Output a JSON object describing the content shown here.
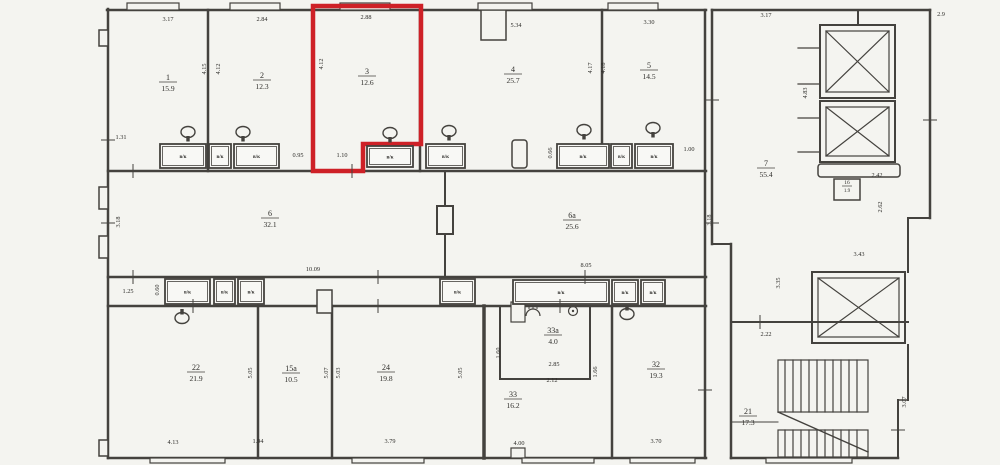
{
  "plan": {
    "type": "architectural-floor-plan",
    "background_color": "#f4f4f0",
    "line_color": "#44423e",
    "highlight": {
      "room_number": "3",
      "color": "#ce2127"
    },
    "vent_box_label": "в/к",
    "rooms": [
      {
        "n": "1",
        "a": "15.9",
        "x": 168,
        "y": 80
      },
      {
        "n": "2",
        "a": "12.3",
        "x": 262,
        "y": 78
      },
      {
        "n": "3",
        "a": "12.6",
        "x": 367,
        "y": 74,
        "red": true
      },
      {
        "n": "4",
        "a": "25.7",
        "x": 513,
        "y": 72
      },
      {
        "n": "5",
        "a": "14.5",
        "x": 649,
        "y": 68
      },
      {
        "n": "6",
        "a": "32.1",
        "x": 270,
        "y": 216
      },
      {
        "n": "6a",
        "a": "25.6",
        "x": 572,
        "y": 218
      },
      {
        "n": "7",
        "a": "55.4",
        "x": 766,
        "y": 166
      },
      {
        "n": "16",
        "a": "1.9",
        "x": 847,
        "y": 184,
        "s": true
      },
      {
        "n": "22",
        "a": "21.9",
        "x": 196,
        "y": 370
      },
      {
        "n": "15a",
        "a": "10.5",
        "x": 291,
        "y": 371
      },
      {
        "n": "24",
        "a": "19.8",
        "x": 386,
        "y": 370
      },
      {
        "n": "33a",
        "a": "4.0",
        "x": 553,
        "y": 333
      },
      {
        "n": "33",
        "a": "16.2",
        "x": 513,
        "y": 397
      },
      {
        "n": "32",
        "a": "19.3",
        "x": 656,
        "y": 367
      },
      {
        "n": "21",
        "a": "17.3",
        "x": 748,
        "y": 414
      }
    ],
    "dims": [
      {
        "t": "3.17",
        "x": 168,
        "y": 21
      },
      {
        "t": "2.84",
        "x": 262,
        "y": 21
      },
      {
        "t": "2.88",
        "x": 366,
        "y": 19
      },
      {
        "t": "5.34",
        "x": 516,
        "y": 27
      },
      {
        "t": "3.30",
        "x": 649,
        "y": 24
      },
      {
        "t": "3.17",
        "x": 766,
        "y": 17
      },
      {
        "t": "2.9",
        "x": 941,
        "y": 16
      },
      {
        "t": "1.31",
        "x": 121,
        "y": 139
      },
      {
        "t": "0.95",
        "x": 298,
        "y": 157
      },
      {
        "t": "1.10",
        "x": 342,
        "y": 157
      },
      {
        "t": "1.00",
        "x": 689,
        "y": 151
      },
      {
        "t": "10.09",
        "x": 313,
        "y": 271
      },
      {
        "t": "8.05",
        "x": 586,
        "y": 267
      },
      {
        "t": "1.25",
        "x": 128,
        "y": 293
      },
      {
        "t": "2.42",
        "x": 877,
        "y": 177
      },
      {
        "t": "3.43",
        "x": 859,
        "y": 256
      },
      {
        "t": "2.22",
        "x": 766,
        "y": 336
      },
      {
        "t": "2.85",
        "x": 554,
        "y": 366
      },
      {
        "t": "2.12",
        "x": 552,
        "y": 382
      },
      {
        "t": "4.13",
        "x": 173,
        "y": 444
      },
      {
        "t": "1.94",
        "x": 258,
        "y": 443
      },
      {
        "t": "3.79",
        "x": 390,
        "y": 443
      },
      {
        "t": "4.00",
        "x": 519,
        "y": 445
      },
      {
        "t": "3.70",
        "x": 656,
        "y": 443
      },
      {
        "t": "4.15",
        "x": 206,
        "y": 69,
        "r": 1
      },
      {
        "t": "4.12",
        "x": 220,
        "y": 69,
        "r": 1
      },
      {
        "t": "4.12",
        "x": 323,
        "y": 64,
        "r": 1
      },
      {
        "t": "4.17",
        "x": 592,
        "y": 68,
        "r": 1
      },
      {
        "t": "4.18",
        "x": 605,
        "y": 68,
        "r": 1
      },
      {
        "t": "4.83",
        "x": 807,
        "y": 93,
        "r": 1
      },
      {
        "t": "3.18",
        "x": 120,
        "y": 222,
        "r": 1
      },
      {
        "t": "3.18",
        "x": 711,
        "y": 220,
        "r": 1
      },
      {
        "t": "0.60",
        "x": 159,
        "y": 290,
        "r": 1
      },
      {
        "t": "0.66",
        "x": 552,
        "y": 153,
        "r": 1
      },
      {
        "t": "2.62",
        "x": 882,
        "y": 207,
        "r": 1
      },
      {
        "t": "3.35",
        "x": 780,
        "y": 283,
        "r": 1
      },
      {
        "t": "5.05",
        "x": 252,
        "y": 373,
        "r": 1
      },
      {
        "t": "5.07",
        "x": 328,
        "y": 373,
        "r": 1
      },
      {
        "t": "5.03",
        "x": 340,
        "y": 373,
        "r": 1
      },
      {
        "t": "5.05",
        "x": 462,
        "y": 373,
        "r": 1
      },
      {
        "t": "1.60",
        "x": 500,
        "y": 353,
        "r": 1
      },
      {
        "t": "1.66",
        "x": 597,
        "y": 372,
        "r": 1
      },
      {
        "t": "3.07",
        "x": 906,
        "y": 402,
        "r": 1
      }
    ],
    "vents": [
      {
        "x": 160,
        "y": 144,
        "w": 46,
        "h": 24
      },
      {
        "x": 209,
        "y": 144,
        "w": 22,
        "h": 24
      },
      {
        "x": 234,
        "y": 144,
        "w": 45,
        "h": 24
      },
      {
        "x": 367,
        "y": 146,
        "w": 46,
        "h": 21
      },
      {
        "x": 426,
        "y": 144,
        "w": 39,
        "h": 24
      },
      {
        "x": 557,
        "y": 144,
        "w": 52,
        "h": 24
      },
      {
        "x": 611,
        "y": 144,
        "w": 21,
        "h": 24
      },
      {
        "x": 635,
        "y": 144,
        "w": 38,
        "h": 24
      },
      {
        "x": 165,
        "y": 279,
        "w": 45,
        "h": 25
      },
      {
        "x": 214,
        "y": 279,
        "w": 21,
        "h": 25
      },
      {
        "x": 238,
        "y": 279,
        "w": 26,
        "h": 25
      },
      {
        "x": 440,
        "y": 279,
        "w": 35,
        "h": 25
      },
      {
        "x": 513,
        "y": 280,
        "w": 96,
        "h": 24
      },
      {
        "x": 612,
        "y": 280,
        "w": 26,
        "h": 24
      },
      {
        "x": 641,
        "y": 280,
        "w": 24,
        "h": 24
      }
    ],
    "fixtures": [
      {
        "type": "toilet",
        "x": 188,
        "y": 132,
        "d": "down"
      },
      {
        "type": "toilet",
        "x": 243,
        "y": 132,
        "d": "down"
      },
      {
        "type": "toilet",
        "x": 390,
        "y": 133,
        "d": "down"
      },
      {
        "type": "toilet",
        "x": 449,
        "y": 131,
        "d": "down"
      },
      {
        "type": "toilet",
        "x": 584,
        "y": 130,
        "d": "down"
      },
      {
        "type": "toilet",
        "x": 653,
        "y": 128,
        "d": "down"
      },
      {
        "type": "toilet",
        "x": 182,
        "y": 318,
        "d": "up"
      },
      {
        "type": "toilet",
        "x": 627,
        "y": 314,
        "d": "up"
      },
      {
        "type": "shower",
        "x": 533,
        "y": 313
      },
      {
        "type": "sink",
        "x": 573,
        "y": 311
      }
    ],
    "ticks": [
      {
        "x": 133,
        "y": 171,
        "o": "h"
      },
      {
        "x": 352,
        "y": 171,
        "o": "h"
      },
      {
        "x": 133,
        "y": 277,
        "o": "h"
      },
      {
        "x": 378,
        "y": 277,
        "o": "h"
      },
      {
        "x": 585,
        "y": 277,
        "o": "h"
      },
      {
        "x": 193,
        "y": 306,
        "o": "h"
      },
      {
        "x": 378,
        "y": 306,
        "o": "h"
      },
      {
        "x": 560,
        "y": 306,
        "o": "h"
      },
      {
        "x": 760,
        "y": 322,
        "o": "h"
      },
      {
        "x": 108,
        "y": 140,
        "o": "v"
      },
      {
        "x": 108,
        "y": 223,
        "o": "v"
      },
      {
        "x": 712,
        "y": 100,
        "o": "v"
      },
      {
        "x": 712,
        "y": 223,
        "o": "v"
      },
      {
        "x": 930,
        "y": 120,
        "o": "v"
      },
      {
        "x": 898,
        "y": 430,
        "o": "v"
      },
      {
        "x": 705,
        "y": 390,
        "o": "v"
      }
    ]
  }
}
